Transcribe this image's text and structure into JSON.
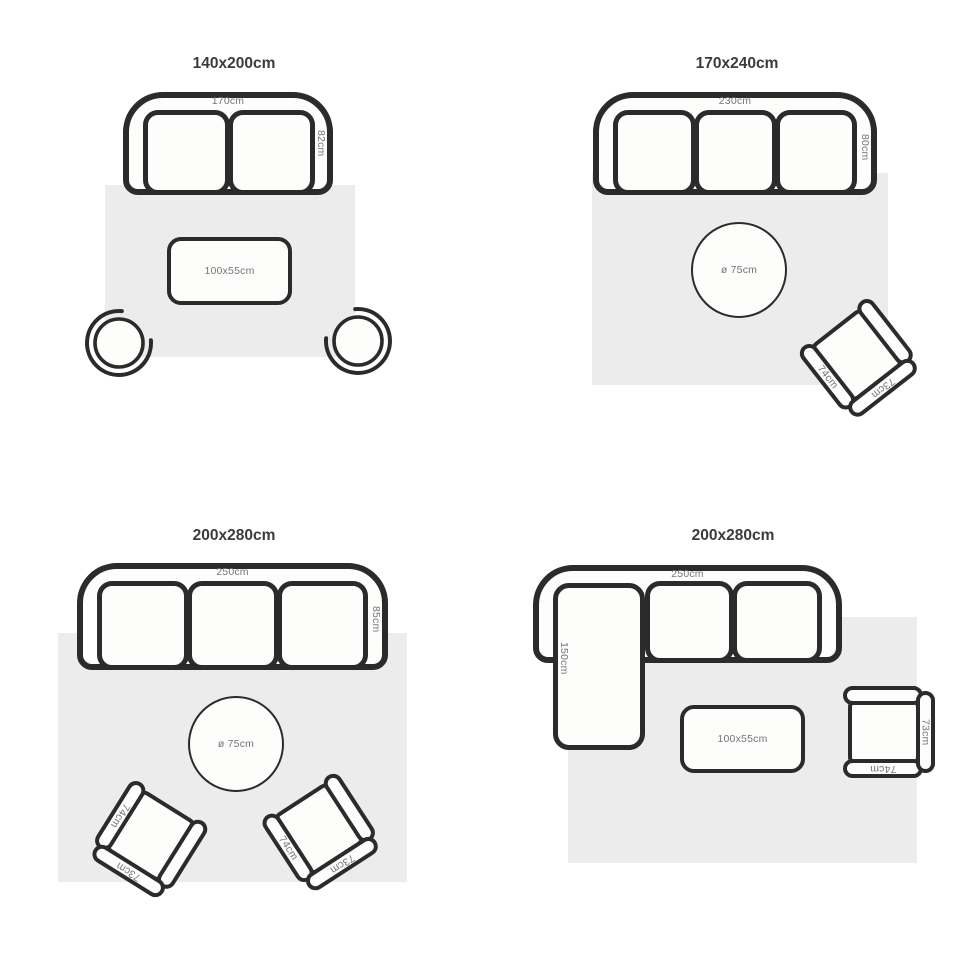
{
  "colors": {
    "background": "#ffffff",
    "rug": "#ececec",
    "outline": "#2b2b2b",
    "furniture_fill": "#fdfdfc",
    "title_text": "#3b3b3b",
    "dimension_text": "#75757a"
  },
  "q1": {
    "title": "140x200cm",
    "sofa_width": "170cm",
    "sofa_depth": "82cm",
    "coffee_table": "100x55cm"
  },
  "q2": {
    "title": "170x240cm",
    "sofa_width": "230cm",
    "sofa_depth": "80cm",
    "round_table": "ø 75cm",
    "chair_width": "74cm",
    "chair_depth": "73cm"
  },
  "q3": {
    "title": "200x280cm",
    "sofa_width": "250cm",
    "sofa_depth": "85cm",
    "round_table": "ø 75cm",
    "chair1_width": "74cm",
    "chair1_depth": "73cm",
    "chair2_width": "74cm",
    "chair2_depth": "73cm"
  },
  "q4": {
    "title": "200x280cm",
    "sofa_width": "250cm",
    "chaise_depth": "150cm",
    "coffee_table": "100x55cm",
    "chair_width": "74cm",
    "chair_depth": "73cm"
  }
}
